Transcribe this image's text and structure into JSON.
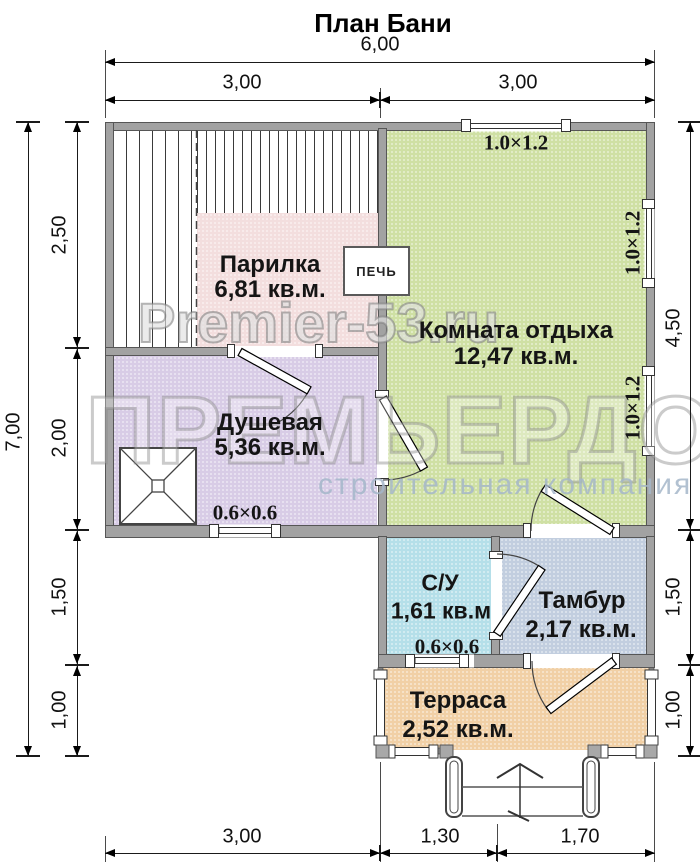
{
  "title": "План Бани",
  "watermark": {
    "site": "Premier-53.ru",
    "name": "ПРЕМЬЕРДОМ",
    "tagline": "строительная компания"
  },
  "rooms": {
    "parilka": {
      "name": "Парилка",
      "area": "6,81 кв.м.",
      "color": "#f3dede"
    },
    "komnata": {
      "name": "Комната отдыха",
      "area": "12,47 кв.м.",
      "color": "#cfe0a4"
    },
    "dushevaya": {
      "name": "Душевая",
      "area": "5,36 кв.м.",
      "color": "#d8cce6"
    },
    "su": {
      "name": "С/У",
      "area": "1,61 кв.м",
      "color": "#b5dfe9"
    },
    "tambur": {
      "name": "Тамбур",
      "area": "2,17 кв.м.",
      "color": "#c2cedf"
    },
    "terrasa": {
      "name": "Терраса",
      "area": "2,52 кв.м.",
      "color": "#f1d0a6"
    }
  },
  "stove": {
    "label": "ПЕЧЬ"
  },
  "windows": {
    "top": "1.0×1.2",
    "right_upper": "1.0×1.2",
    "right_lower": "1.0×1.2",
    "shower": "0.6×0.6",
    "wc": "0.6×0.6"
  },
  "dims": {
    "top_total": "6,00",
    "top_left": "3,00",
    "top_right": "3,00",
    "left_total": "7,00",
    "left_1": "2,50",
    "left_2": "2,00",
    "left_3": "1,50",
    "left_4": "1,00",
    "right_1": "4,50",
    "right_2": "1,50",
    "right_3": "1,00",
    "bottom_1": "3,00",
    "bottom_2": "1,30",
    "bottom_3": "1,70"
  },
  "wall_color": "#a2a2a2"
}
